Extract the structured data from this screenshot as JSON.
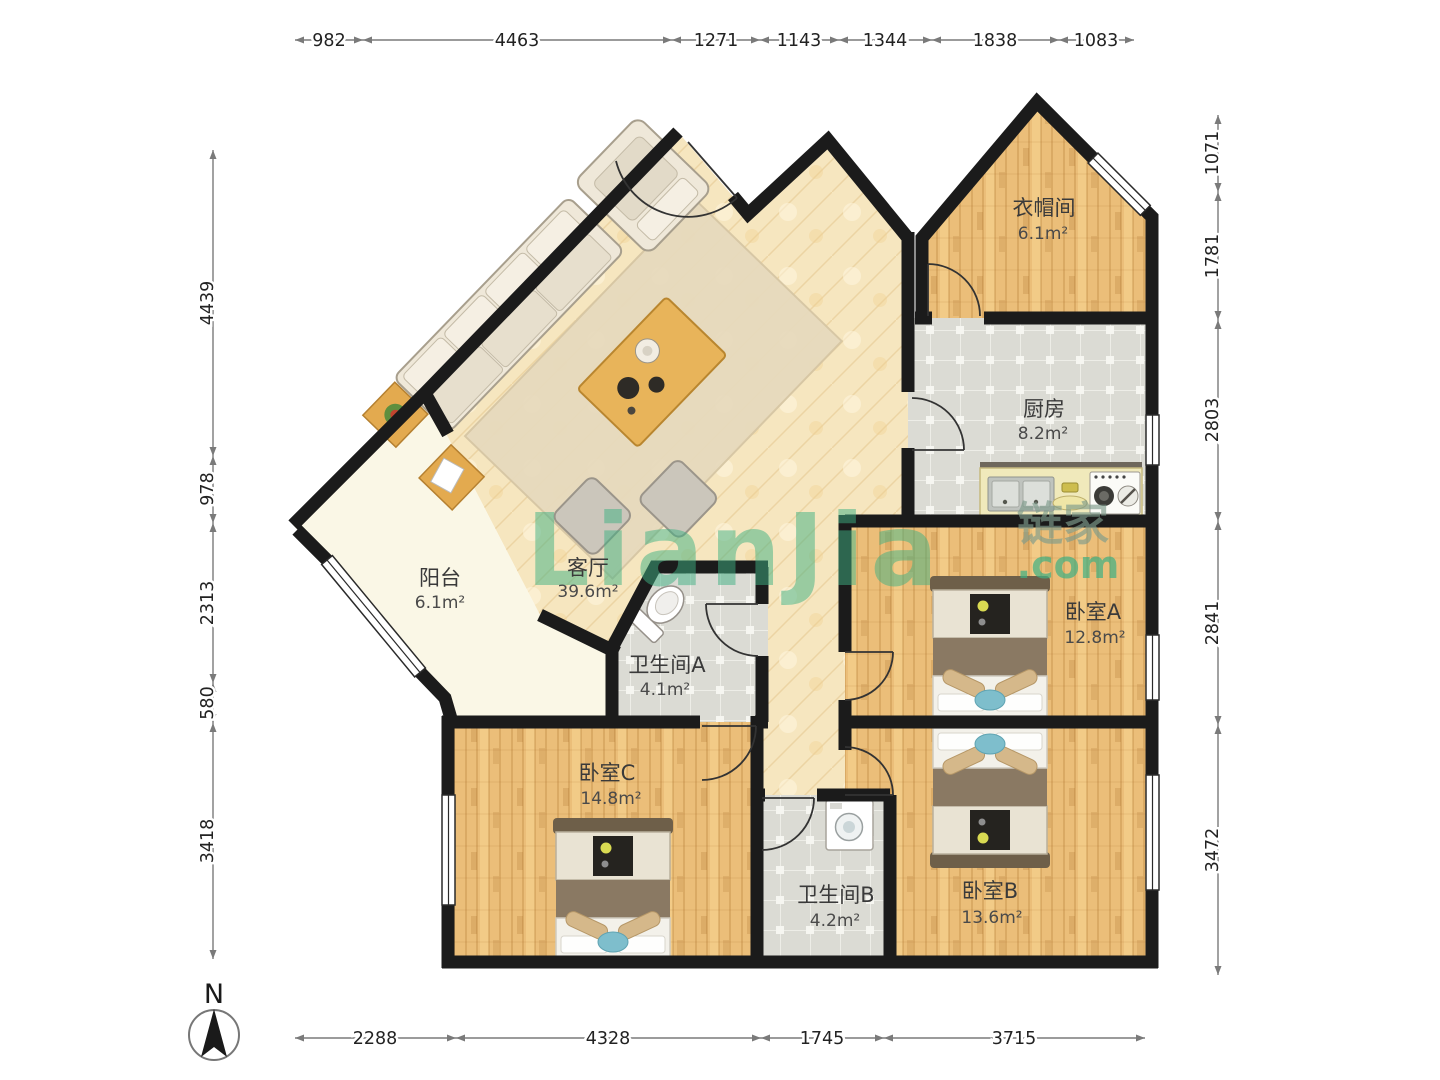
{
  "watermark": {
    "brand": "LianJia",
    "cjk": "链家",
    "tld": ".com"
  },
  "compass": {
    "label": "N"
  },
  "rooms": [
    {
      "name": "衣帽间",
      "area": "6.1m²"
    },
    {
      "name": "厨房",
      "area": "8.2m²"
    },
    {
      "name": "客厅",
      "area": "39.6m²"
    },
    {
      "name": "阳台",
      "area": "6.1m²"
    },
    {
      "name": "卫生间A",
      "area": "4.1m²"
    },
    {
      "name": "卧室A",
      "area": "12.8m²"
    },
    {
      "name": "卧室C",
      "area": "14.8m²"
    },
    {
      "name": "卫生间B",
      "area": "4.2m²"
    },
    {
      "name": "卧室B",
      "area": "13.6m²"
    }
  ],
  "dimensions": {
    "top": [
      {
        "value": "982"
      },
      {
        "value": "4463"
      },
      {
        "value": "1271"
      },
      {
        "value": "1143"
      },
      {
        "value": "1344"
      },
      {
        "value": "1838"
      },
      {
        "value": "1083"
      }
    ],
    "left": [
      {
        "value": "4439"
      },
      {
        "value": "978"
      },
      {
        "value": "2313"
      },
      {
        "value": "580"
      },
      {
        "value": "3418"
      }
    ],
    "right": [
      {
        "value": "1071"
      },
      {
        "value": "1781"
      },
      {
        "value": "2803"
      },
      {
        "value": "2841"
      },
      {
        "value": "3472"
      }
    ],
    "bottom": [
      {
        "value": "2288"
      },
      {
        "value": "4328"
      },
      {
        "value": "1745"
      },
      {
        "value": "3715"
      }
    ]
  }
}
